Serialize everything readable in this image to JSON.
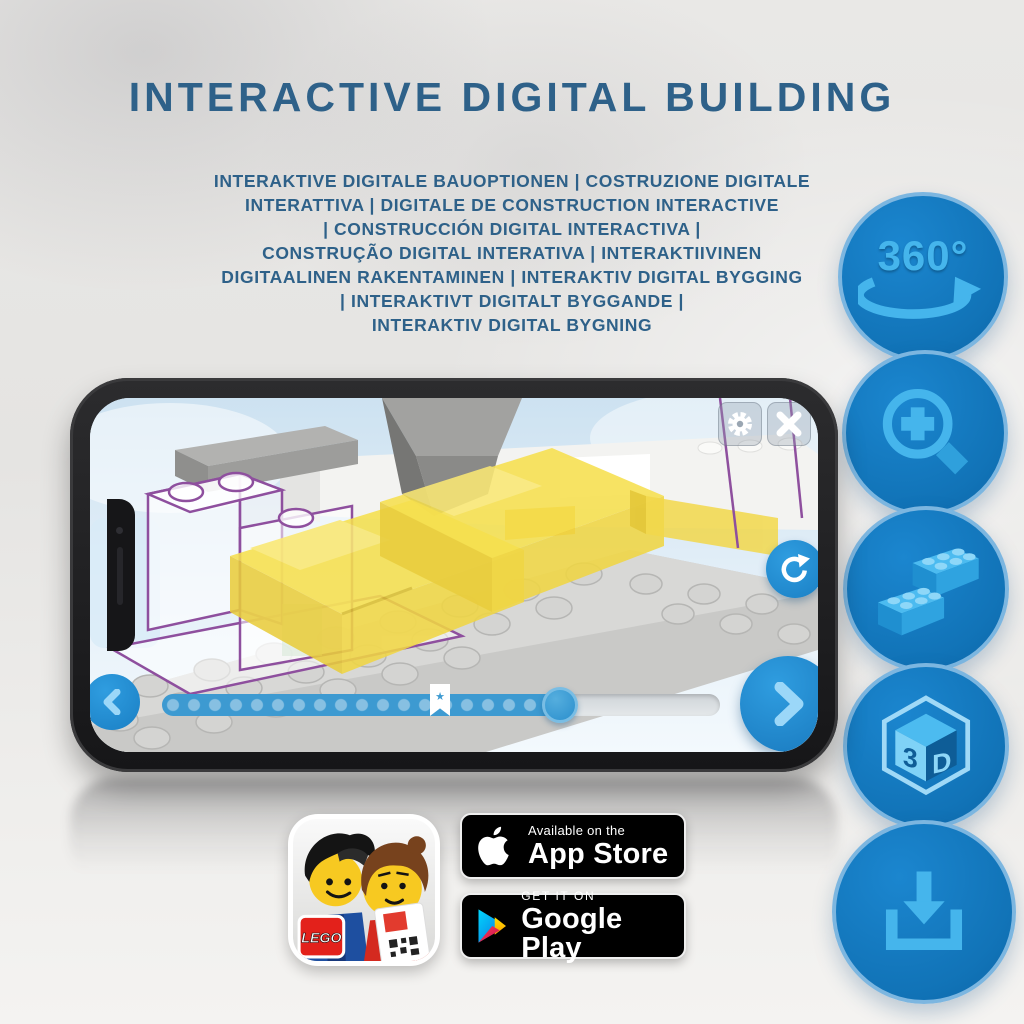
{
  "title": "INTERACTIVE DIGITAL BUILDING",
  "subtitle_lines": [
    "INTERAKTIVE DIGITALE BAUOPTIONEN | COSTRUZIONE DIGITALE",
    "INTERATTIVA | DIGITALE DE CONSTRUCTION INTERACTIVE",
    "| CONSTRUCCIÓN DIGITAL INTERACTIVA |",
    "CONSTRUÇÃO DIGITAL INTERATIVA | INTERAKTIIVINEN",
    "DIGITAALINEN RAKENTAMINEN | INTERAKTIV DIGITAL BYGGING",
    "| INTERAKTIVT DIGITALT BYGGANDE |",
    "INTERAKTIV DIGITAL BYGNING"
  ],
  "feature_icons": {
    "rotate_label": "360°",
    "cube_left": "3",
    "cube_right": "D",
    "items": [
      {
        "name": "360-rotation"
      },
      {
        "name": "zoom-in"
      },
      {
        "name": "lego-bricks"
      },
      {
        "name": "3d-view"
      },
      {
        "name": "download"
      }
    ]
  },
  "glyphs": {
    "bookmark_star": "★"
  },
  "badges": {
    "app_store": {
      "line1": "Available on the",
      "line2": "App Store"
    },
    "google_play": {
      "line1": "GET IT ON",
      "line2": "Google Play"
    }
  },
  "app_icon": {
    "brand": "LEGO"
  },
  "colors": {
    "title_blue": "#2e6189",
    "circle_blue": "#1173b7",
    "glyph_light_blue": "#45b5ec",
    "app_button_blue": "#2f9de0",
    "lego_yellow": "#f4dc52",
    "ghost_outline_purple": "#8e4f9e"
  }
}
